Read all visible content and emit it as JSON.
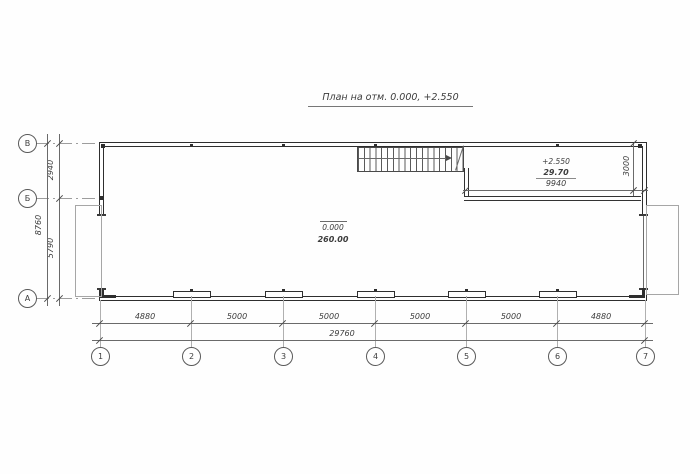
{
  "title": "План на отм. 0.000, +2.550",
  "grid": {
    "columns": [
      "1",
      "2",
      "3",
      "4",
      "5",
      "6",
      "7"
    ],
    "rows": [
      "В",
      "Б",
      "А"
    ]
  },
  "dimensions": {
    "bottom_segments": [
      "4880",
      "5000",
      "5000",
      "5000",
      "5000",
      "4880"
    ],
    "bottom_total": "29760",
    "left_segments": [
      "2940",
      "5790"
    ],
    "left_total": "8760",
    "mezzanine_width": "9940",
    "mezzanine_depth": "3000"
  },
  "rooms": {
    "ground": {
      "elevation": "0.000",
      "area": "260.00"
    },
    "mezzanine": {
      "elevation": "+2.550",
      "area": "29.70"
    }
  },
  "icons": {
    "stair_direction_arrow": "right"
  },
  "colors": {
    "wall": "#2e2e2e",
    "thin_line": "#6a6a6a",
    "aux_line": "#a6a6a6",
    "text": "#3d3d3d",
    "background": "#fefefe"
  }
}
